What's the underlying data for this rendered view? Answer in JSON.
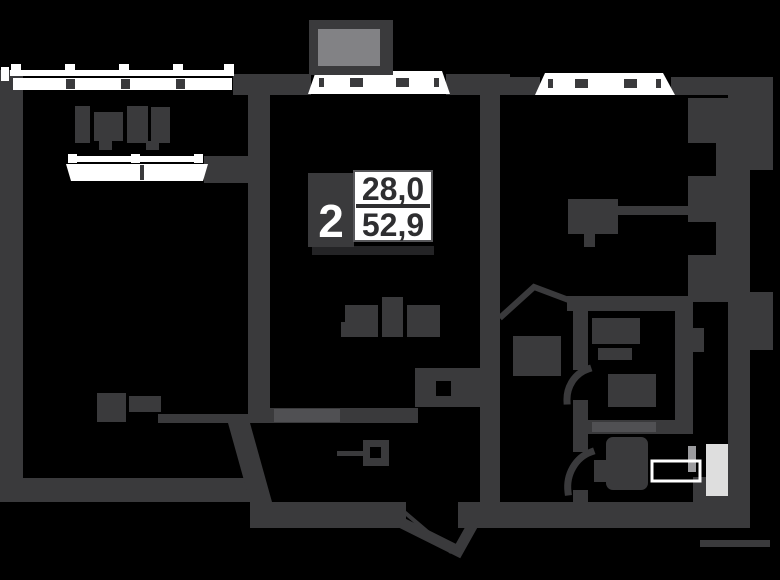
{
  "plan": {
    "title": "apartment-floor-plan",
    "badge": {
      "rooms": "2",
      "area_upper": "28,0",
      "area_lower": "52,9"
    },
    "colors": {
      "background": "#000000",
      "wall": "#3a3a3c",
      "wall_light": "#505053",
      "window": "#ffffff",
      "balcony_fill": "#828285",
      "badge_box": "#3a3a3c",
      "badge_panel": "#ffffff",
      "badge_text": "#2e2e30",
      "badge_shadow": "#242426",
      "fixture_light": "#dedede",
      "fixture_mid": "#9b9b9e"
    }
  }
}
